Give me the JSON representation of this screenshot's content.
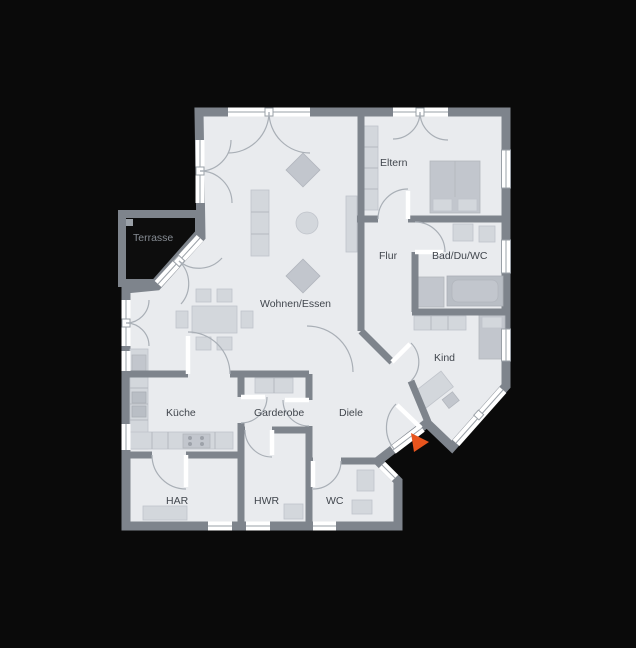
{
  "canvas": {
    "width": 636,
    "height": 648,
    "background": "#0a0a0a"
  },
  "palette": {
    "floor": "#e9ebee",
    "wall": "#7e848c",
    "furniture_light": "#d3d7dc",
    "furniture_mid": "#c2c6cd",
    "furniture_dark": "#b9bec5",
    "window_white": "#ffffff",
    "frame_line": "#9aa0a7",
    "swing_arc": "#a9afb6",
    "label_color": "#41464d",
    "terrace_label_color": "#868c93",
    "entrance_arrow": "#e8541d"
  },
  "rooms": [
    {
      "id": "terrasse",
      "label": "Terrasse"
    },
    {
      "id": "wohnen-essen",
      "label": "Wohnen/Essen"
    },
    {
      "id": "eltern",
      "label": "Eltern"
    },
    {
      "id": "flur",
      "label": "Flur"
    },
    {
      "id": "bad",
      "label": "Bad/Du/WC"
    },
    {
      "id": "kind",
      "label": "Kind"
    },
    {
      "id": "kueche",
      "label": "Küche"
    },
    {
      "id": "garderobe",
      "label": "Garderobe"
    },
    {
      "id": "diele",
      "label": "Diele"
    },
    {
      "id": "har",
      "label": "HAR"
    },
    {
      "id": "hwr",
      "label": "HWR"
    },
    {
      "id": "wc",
      "label": "WC"
    }
  ],
  "marker": {
    "entrance_arrow": "entrance-direction-marker"
  }
}
